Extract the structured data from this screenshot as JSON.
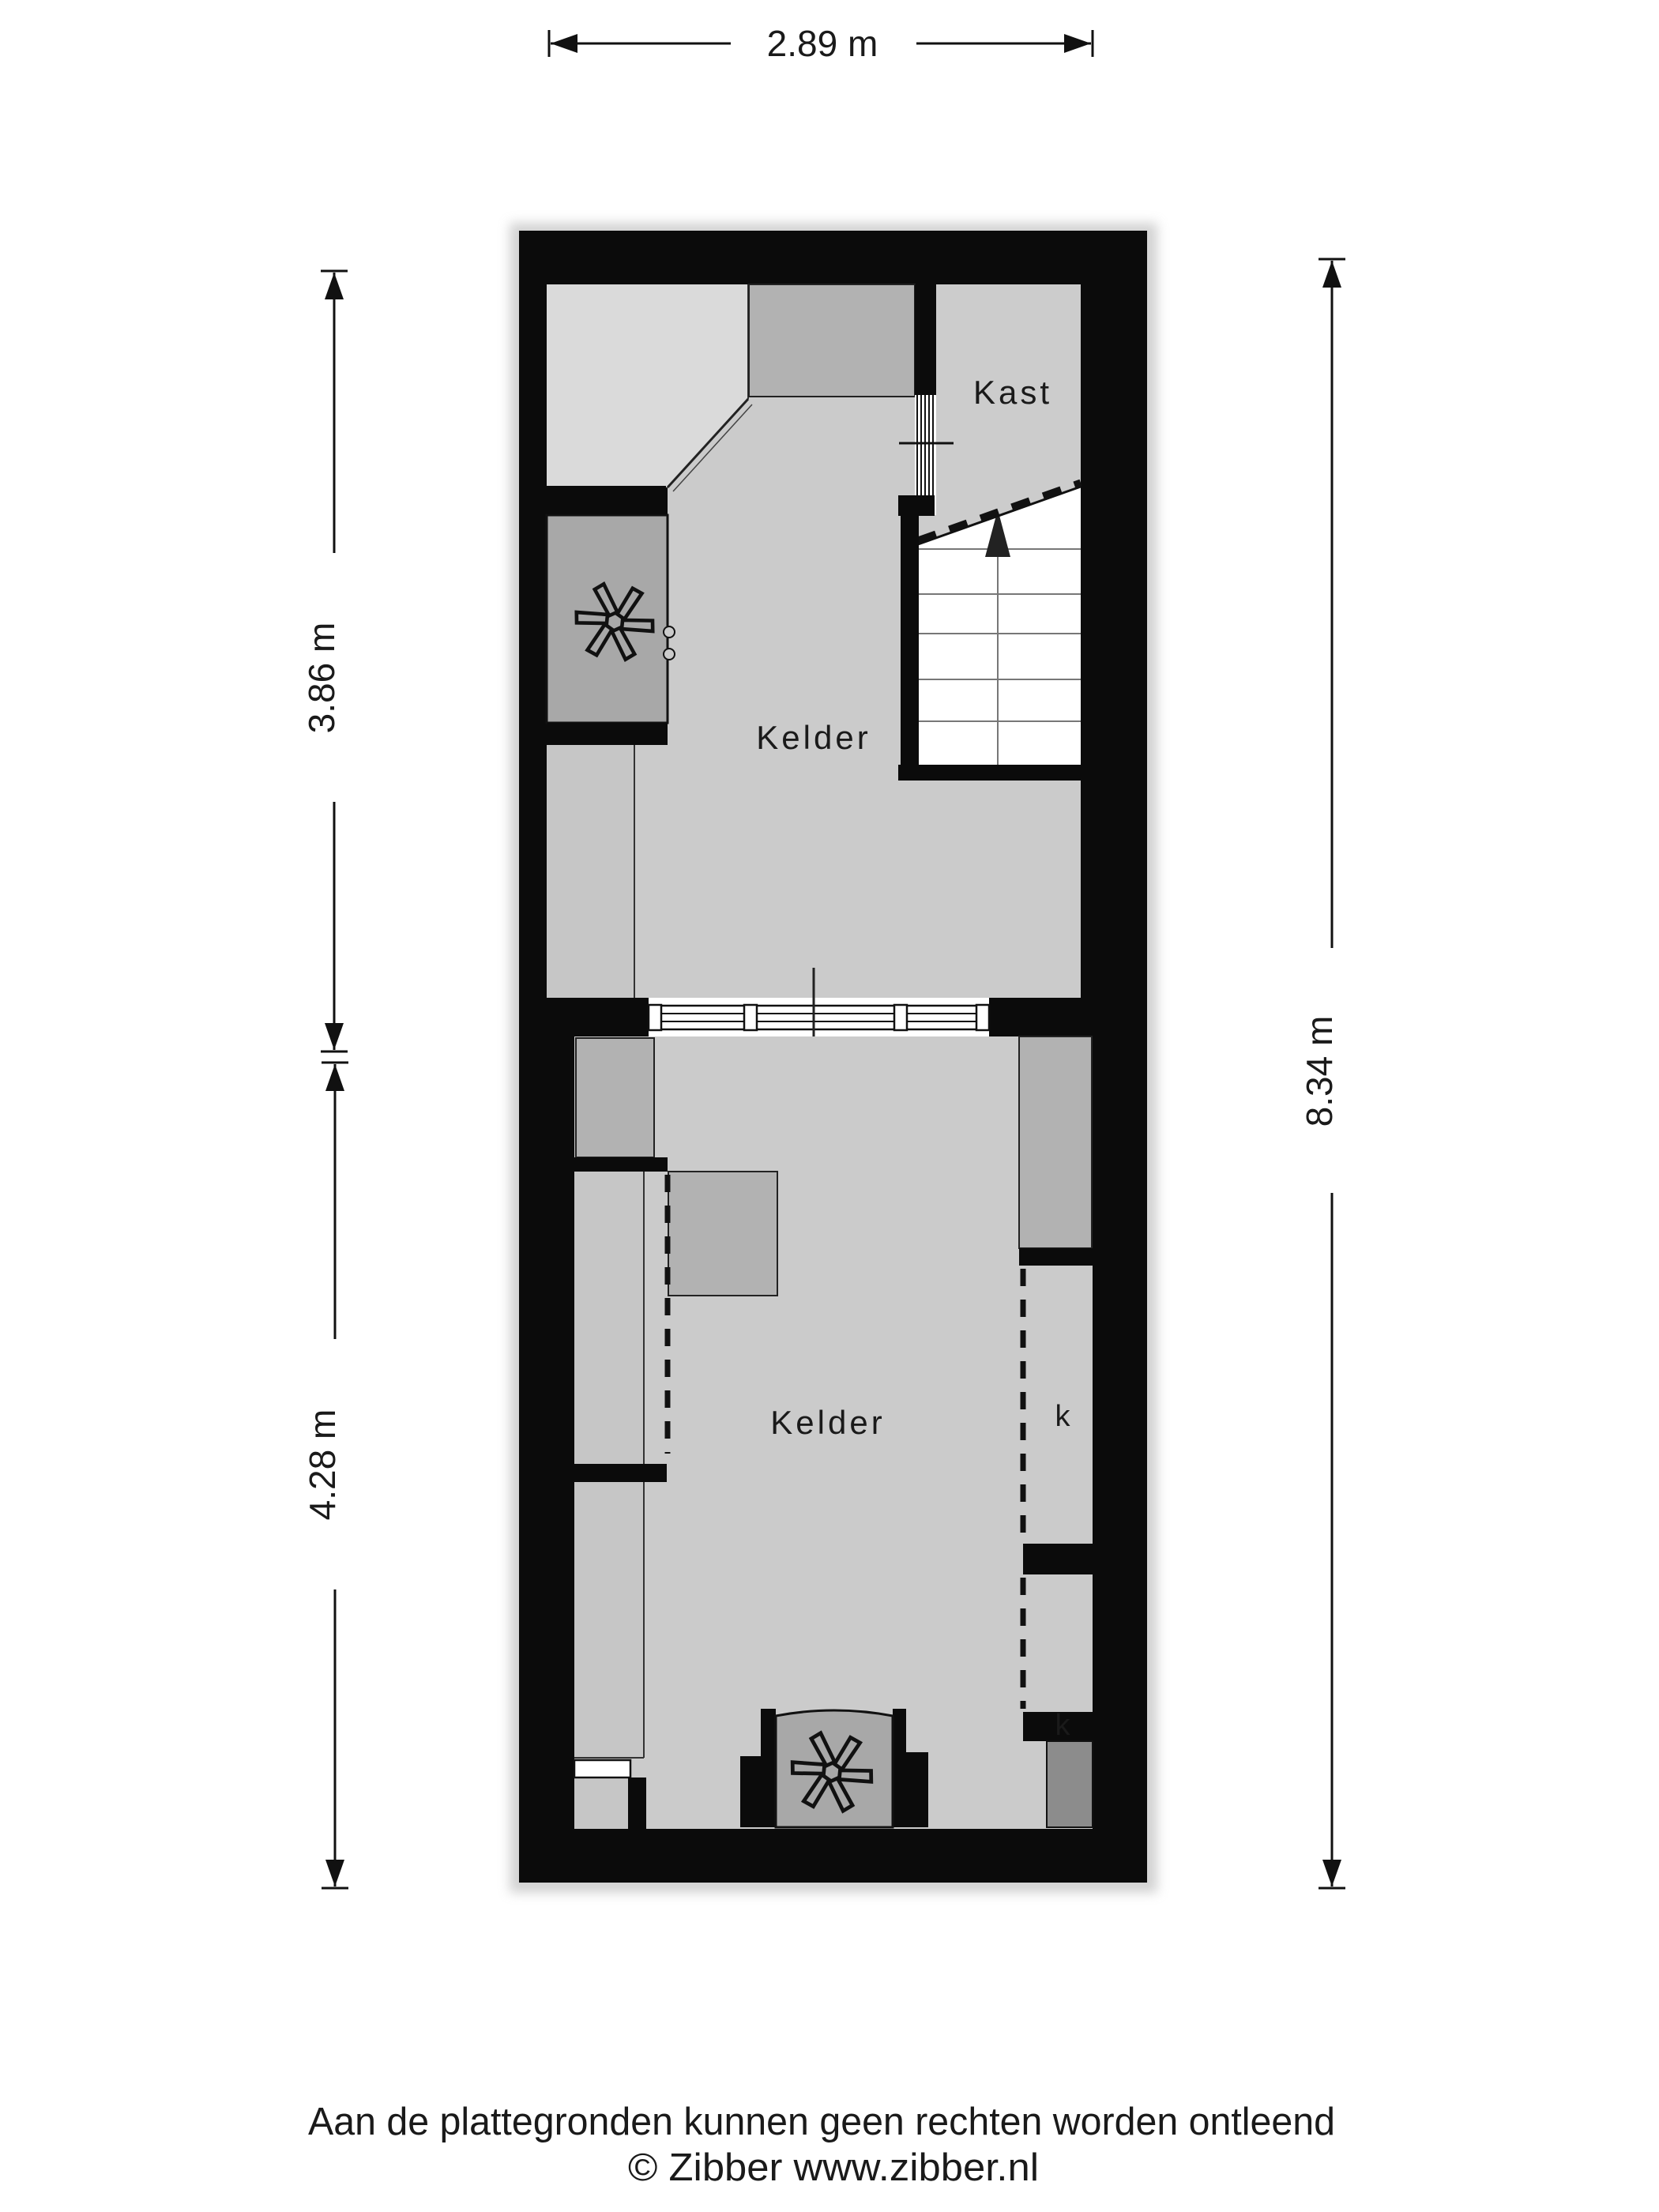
{
  "dimensions": {
    "top": "2.89 m",
    "left_upper": "3.86 m",
    "left_lower": "4.28 m",
    "right": "8.34 m"
  },
  "rooms": {
    "kast": "Kast",
    "kelder_upper": "Kelder",
    "kelder_lower": "Kelder",
    "closet_1": "k",
    "closet_2": "k"
  },
  "footer": {
    "line1": "Aan de plattegronden kunnen geen rechten worden ontleend",
    "line2": "© Zibber www.zibber.nl"
  },
  "icons": {
    "fan_upper": "fan-icon",
    "fan_lower": "fan-icon",
    "stairs_arrow": "stairs-up-arrow-icon"
  },
  "colors": {
    "wall": "#0b0b0b",
    "floor": "#cbcbcb",
    "bay_floor": "#dadada",
    "furniture": "#b2b2b2",
    "unit": "#a8a8a8",
    "strip": "#c6c6c6",
    "dark_block": "#8c8c8c",
    "stairs": "#ffffff",
    "background": "#ffffff"
  }
}
